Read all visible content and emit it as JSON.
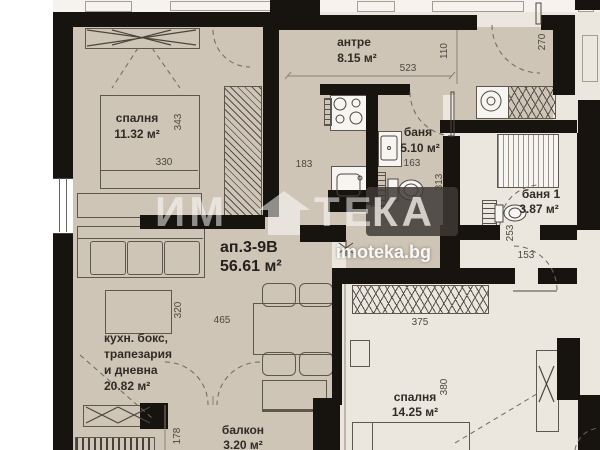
{
  "title": {
    "id": "ап.3-9В",
    "area": "56.61 м²"
  },
  "watermark": {
    "p1": "ИМ",
    "p2": "ТЕ",
    "p3": "КА",
    "url": "imoteka.bg",
    "house_icon": "house-icon"
  },
  "rooms": {
    "bedroom1": {
      "name": "спалня",
      "area": "11.32 м²"
    },
    "entry": {
      "name": "антре",
      "area": "8.15 м²"
    },
    "bath": {
      "name": "баня",
      "area": "5.10 м²"
    },
    "bath1": {
      "name": "баня 1",
      "area": "3.87 м²"
    },
    "living": {
      "line1": "кухн. бокс,",
      "line2": "трапезария",
      "line3": "и дневна",
      "area": "20.82 м²"
    },
    "balcony": {
      "name": "балкон",
      "area": "3.20 м²"
    },
    "bedroom2": {
      "name": "спалня",
      "area": "14.25 м²"
    }
  },
  "dims": {
    "d330": "330",
    "d343": "343",
    "d183": "183",
    "d523": "523",
    "d110": "110",
    "d270": "270",
    "d163": "163",
    "d313": "313",
    "d253": "253",
    "d153": "153",
    "d465": "465",
    "d320": "320",
    "d375": "375",
    "d380": "380",
    "d178": "178"
  },
  "colors": {
    "floor_main": "#cfc5b6",
    "floor_neighbor": "#ece7de",
    "wall": "#17130e",
    "watermark_box": "#3e3a35"
  },
  "icons": {
    "stove": "stove-icon",
    "kitchen_sink": "sink-icon",
    "bath_sink": "washbasin-icon",
    "toilet": "toilet-icon",
    "washing_machine": "washing-machine-icon",
    "shower": "shower-icon",
    "wardrobe": "wardrobe-icon",
    "radiator": "radiator-icon",
    "bed": "bed-icon",
    "sofa": "sofa-icon",
    "table": "table-icon",
    "door_arc": "door-arc-icon"
  }
}
